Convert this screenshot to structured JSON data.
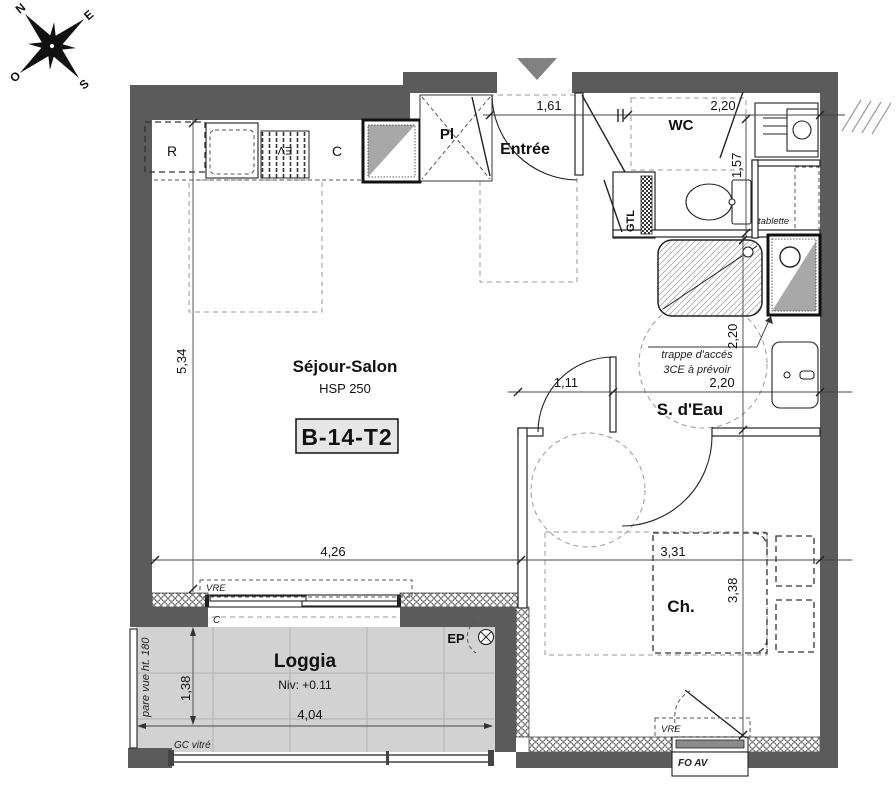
{
  "compass": {
    "n": "N",
    "e": "E",
    "s": "S",
    "o": "O"
  },
  "unit_code": "B-14-T2",
  "rooms": {
    "sejour": {
      "name": "Séjour-Salon",
      "ceiling": "HSP 250",
      "dim_width": "4,26",
      "dim_height": "5,34"
    },
    "entree": {
      "name": "Entrée",
      "dim_width": "1,61"
    },
    "wc": {
      "name": "WC",
      "dim_width": "2,20",
      "dim_height": "1,57"
    },
    "sdeau": {
      "name": "S. d'Eau",
      "dim_width": "2,20",
      "dim_height": "2,20",
      "door_dim": "1,11",
      "note_line1": "trappe d'accés",
      "note_line2": "3CE à prévoir"
    },
    "chambre": {
      "name": "Ch.",
      "dim_width": "3,31",
      "dim_height": "3,38"
    },
    "loggia": {
      "name": "Loggia",
      "level": "Niv: +0.11",
      "dim_width": "4,04",
      "dim_height": "1,38"
    },
    "placard": "Pl",
    "gtl": "GTL"
  },
  "kitchen": {
    "fridge": "R",
    "cooking": "C",
    "sink": "EV"
  },
  "fixtures": {
    "shelf": "tablette"
  },
  "openings": {
    "vre_sejour": "VRE",
    "vre_chambre": "VRE",
    "window_chambre": "FO AV",
    "sill": "C",
    "rail": "GC vitré",
    "screen": "pare vue ht. 180"
  },
  "misc": {
    "drain": "EP"
  }
}
